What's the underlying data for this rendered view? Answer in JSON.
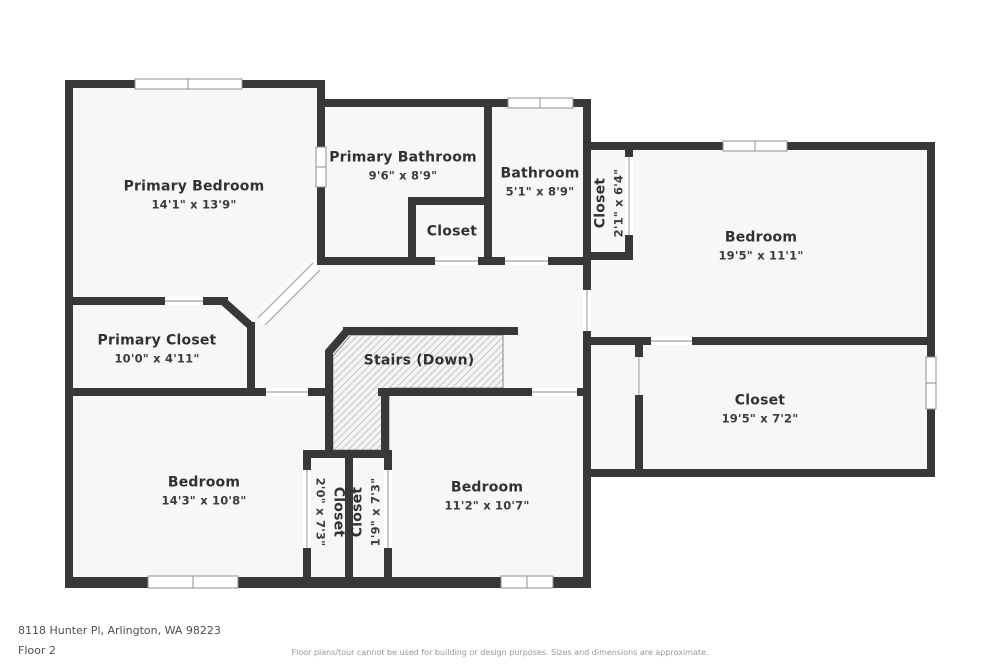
{
  "colors": {
    "wall": "#383838",
    "floor": "#f7f7f7",
    "outside": "#ffffff",
    "window_line": "#8f8f8f",
    "door_line": "#b3b3b3",
    "hatch_line": "#c6c6c6",
    "label_text": "#313131",
    "footer_text": "#4f4f4f",
    "disclaimer_text": "#979797"
  },
  "rooms": {
    "primary_bedroom": {
      "name": "Primary Bedroom",
      "dims": "14'1\" x 13'9\""
    },
    "primary_bathroom": {
      "name": "Primary Bathroom",
      "dims": "9'6\" x 8'9\""
    },
    "bathroom": {
      "name": "Bathroom",
      "dims": "5'1\" x 8'9\""
    },
    "hall_closet": {
      "name": "Closet",
      "dims": "2'1\" x 6'4\""
    },
    "bedroom_ne": {
      "name": "Bedroom",
      "dims": "19'5\" x 11'1\""
    },
    "bath_closet": {
      "name": "Closet"
    },
    "primary_closet": {
      "name": "Primary Closet",
      "dims": "10'0\" x 4'11\""
    },
    "stairs": {
      "name": "Stairs (Down)"
    },
    "closet_e": {
      "name": "Closet",
      "dims": "19'5\" x 7'2\""
    },
    "bedroom_sw": {
      "name": "Bedroom",
      "dims": "14'3\" x 10'8\""
    },
    "closet_s1": {
      "name": "Closet",
      "dims": "2'0\" x 7'3\""
    },
    "closet_s2": {
      "name": "Closet",
      "dims": "1'9\" x 7'3\""
    },
    "bedroom_se": {
      "name": "Bedroom",
      "dims": "11'2\" x 10'7\""
    }
  },
  "footer": {
    "address": "8118 Hunter Pl, Arlington, WA 98223",
    "floor_label": "Floor 2",
    "disclaimer": "Floor plans/tour cannot be used for building or design purposes. Sizes and dimensions are approximate."
  }
}
